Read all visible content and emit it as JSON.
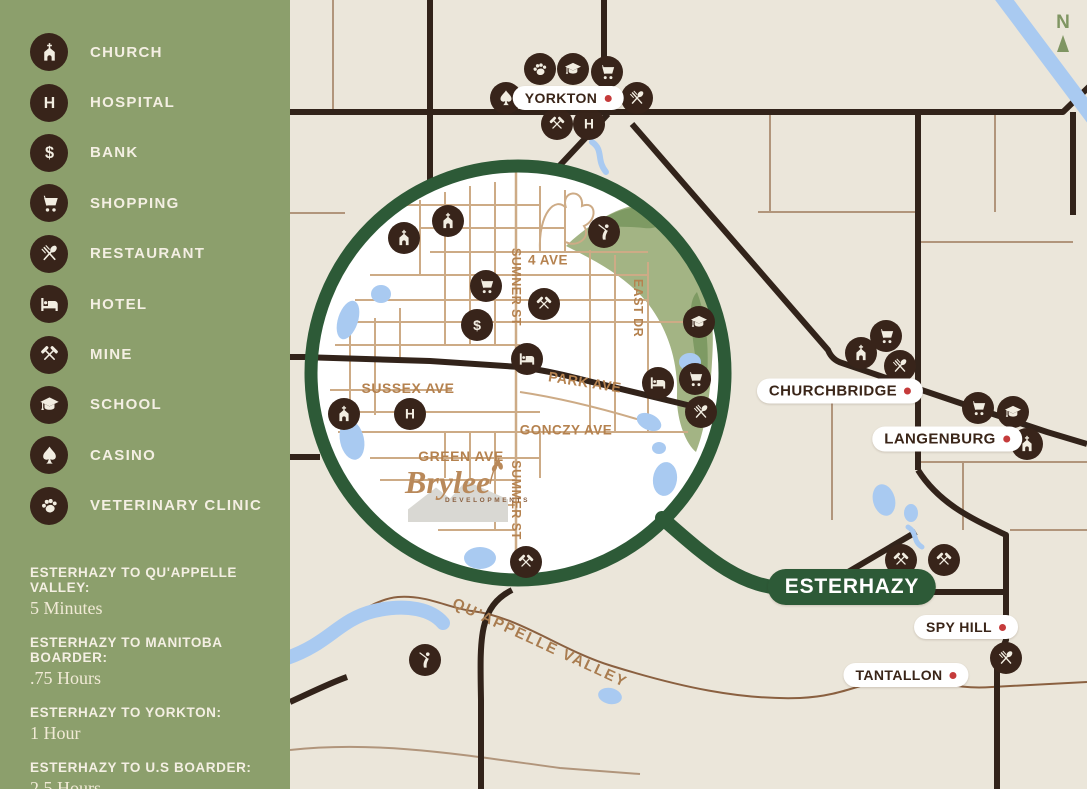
{
  "sidebar": {
    "legend": [
      {
        "icon": "church",
        "label": "CHURCH"
      },
      {
        "icon": "hospital",
        "label": "HOSPITAL"
      },
      {
        "icon": "bank",
        "label": "BANK"
      },
      {
        "icon": "shopping",
        "label": "SHOPPING"
      },
      {
        "icon": "restaurant",
        "label": "RESTAURANT"
      },
      {
        "icon": "hotel",
        "label": "HOTEL"
      },
      {
        "icon": "mine",
        "label": "MINE"
      },
      {
        "icon": "school",
        "label": "SCHOOL"
      },
      {
        "icon": "casino",
        "label": "CASINO"
      },
      {
        "icon": "vet",
        "label": "VETERINARY CLINIC"
      }
    ],
    "distances": [
      {
        "label": "ESTERHAZY TO QU'APPELLE VALLEY:",
        "value": "5 Minutes"
      },
      {
        "label": "ESTERHAZY TO MANITOBA BOARDER:",
        "value": ".75 Hours"
      },
      {
        "label": "ESTERHAZY TO YORKTON:",
        "value": "1 Hour"
      },
      {
        "label": "ESTERHAZY TO U.S BOARDER:",
        "value": "2.5 Hours"
      }
    ]
  },
  "map": {
    "compass": "N",
    "region_label": {
      "text": "QU'APPELLE VALLEY",
      "x": 540,
      "y": 643,
      "rot": 25
    },
    "towns": [
      {
        "name": "YORKTON",
        "x": 568,
        "y": 98,
        "style": "white",
        "dot": true,
        "size": 14
      },
      {
        "name": "CHURCHBRIDGE",
        "x": 840,
        "y": 391,
        "style": "white",
        "dot": true,
        "size": 15
      },
      {
        "name": "LANGENBURG",
        "x": 947,
        "y": 439,
        "style": "white",
        "dot": true,
        "size": 15
      },
      {
        "name": "ESTERHAZY",
        "x": 852,
        "y": 587,
        "style": "green",
        "dot": false,
        "size": 21
      },
      {
        "name": "SPY HILL",
        "x": 966,
        "y": 627,
        "style": "white",
        "dot": true,
        "size": 14
      },
      {
        "name": "TANTALLON",
        "x": 906,
        "y": 675,
        "style": "white",
        "dot": true,
        "size": 14
      }
    ],
    "streets": [
      {
        "name": "4 AVE",
        "x": 548,
        "y": 260,
        "rot": 0,
        "size": 13.5
      },
      {
        "name": "SUMNER ST",
        "x": 516,
        "y": 287,
        "rot": 90,
        "size": 12.5
      },
      {
        "name": "EAST DR",
        "x": 638,
        "y": 308,
        "rot": 90,
        "size": 12.5
      },
      {
        "name": "PARK AVE",
        "x": 585,
        "y": 382,
        "rot": 9,
        "size": 14
      },
      {
        "name": "SUSSEX AVE",
        "x": 408,
        "y": 388,
        "rot": 0,
        "size": 14
      },
      {
        "name": "GONCZY AVE",
        "x": 566,
        "y": 430,
        "rot": 0,
        "size": 13.5
      },
      {
        "name": "GREEN AVE",
        "x": 461,
        "y": 456,
        "rot": 0,
        "size": 14
      },
      {
        "name": "SUMMER ST",
        "x": 516,
        "y": 500,
        "rot": 90,
        "size": 12.5
      }
    ],
    "icons": [
      {
        "type": "vet",
        "x": 540,
        "y": 69
      },
      {
        "type": "school",
        "x": 573,
        "y": 69
      },
      {
        "type": "shopping",
        "x": 607,
        "y": 72
      },
      {
        "type": "casino",
        "x": 506,
        "y": 98
      },
      {
        "type": "restaurant",
        "x": 637,
        "y": 98
      },
      {
        "type": "mine",
        "x": 557,
        "y": 124
      },
      {
        "type": "hospital",
        "x": 589,
        "y": 124
      },
      {
        "type": "shopping",
        "x": 886,
        "y": 336
      },
      {
        "type": "church",
        "x": 861,
        "y": 353
      },
      {
        "type": "restaurant",
        "x": 900,
        "y": 366
      },
      {
        "type": "shopping",
        "x": 978,
        "y": 408
      },
      {
        "type": "school",
        "x": 1013,
        "y": 412
      },
      {
        "type": "church",
        "x": 1027,
        "y": 444
      },
      {
        "type": "mine",
        "x": 901,
        "y": 560
      },
      {
        "type": "mine",
        "x": 944,
        "y": 560
      },
      {
        "type": "restaurant",
        "x": 1006,
        "y": 658
      },
      {
        "type": "golf",
        "x": 604,
        "y": 232
      },
      {
        "type": "golf",
        "x": 425,
        "y": 660
      },
      {
        "type": "church",
        "x": 404,
        "y": 238
      },
      {
        "type": "church",
        "x": 448,
        "y": 221
      },
      {
        "type": "shopping",
        "x": 486,
        "y": 286
      },
      {
        "type": "bank",
        "x": 477,
        "y": 325
      },
      {
        "type": "mine",
        "x": 544,
        "y": 304
      },
      {
        "type": "hotel",
        "x": 527,
        "y": 359
      },
      {
        "type": "school",
        "x": 699,
        "y": 322
      },
      {
        "type": "hotel",
        "x": 658,
        "y": 383
      },
      {
        "type": "shopping",
        "x": 695,
        "y": 379
      },
      {
        "type": "restaurant",
        "x": 701,
        "y": 412
      },
      {
        "type": "church",
        "x": 344,
        "y": 414
      },
      {
        "type": "hospital",
        "x": 410,
        "y": 414
      },
      {
        "type": "mine",
        "x": 526,
        "y": 562
      }
    ],
    "logo": {
      "name": "Brylee",
      "sub": "DEVELOPMENTS"
    }
  },
  "colors": {
    "sidebar_green": "#8c9f6c",
    "ring_green": "#2d5a37",
    "icon_brown": "#38241a",
    "cream": "#f2ede1",
    "map_bg": "#ebe6da",
    "water": "#a9caf1",
    "road_dark": "#32231a",
    "road_tan": "#b1957b",
    "street_label": "#b5824f",
    "red_dot": "#c53b3b",
    "golf_green": "#a3b484",
    "golf_dark": "#7e9a63"
  }
}
